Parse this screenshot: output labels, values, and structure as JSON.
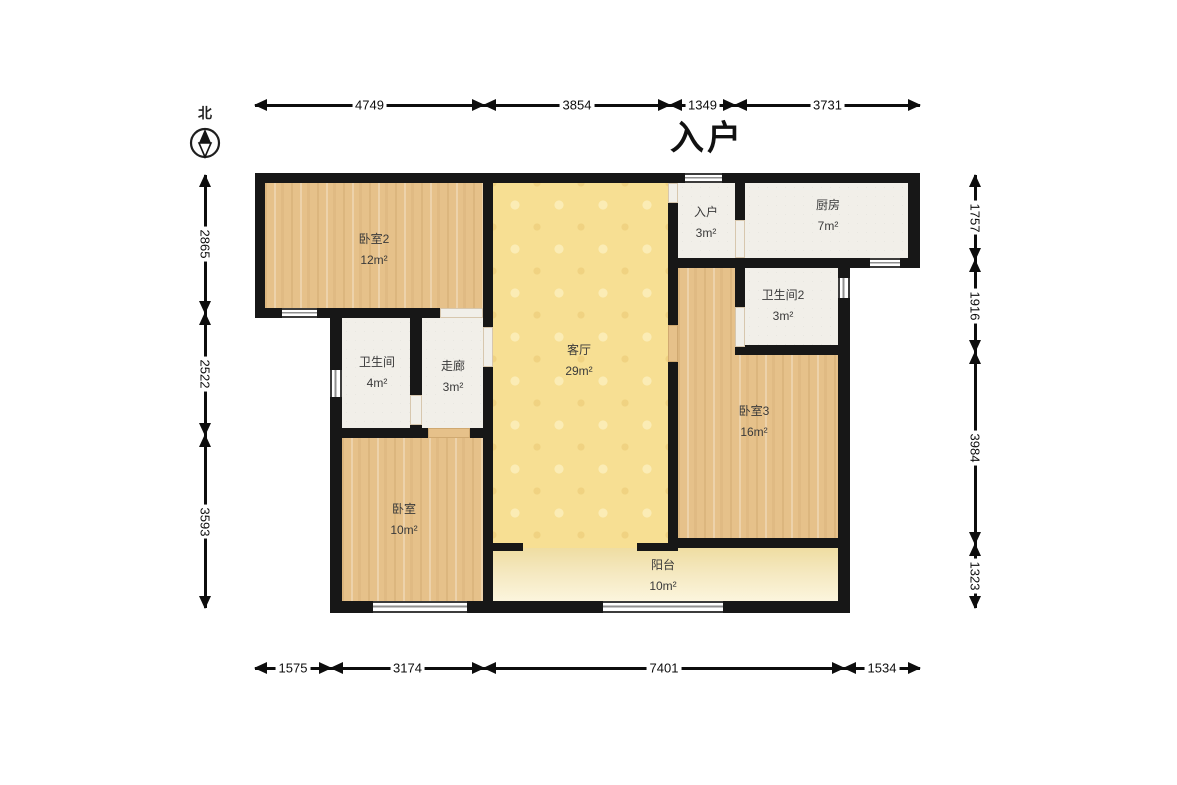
{
  "title": "入户",
  "compass": {
    "label": "北"
  },
  "rooms": [
    {
      "id": "bedroom2",
      "name": "卧室2",
      "area": "12m²",
      "floor": "wood",
      "rect": [
        265,
        183,
        218,
        125
      ],
      "label": [
        374,
        250
      ]
    },
    {
      "id": "living",
      "name": "客厅",
      "area": "29m²",
      "floor": "living",
      "rect": [
        493,
        183,
        175,
        365
      ],
      "label": [
        579,
        361
      ]
    },
    {
      "id": "entry",
      "name": "入户",
      "area": "3m²",
      "floor": "white",
      "rect": [
        678,
        183,
        57,
        75
      ],
      "label": [
        706,
        223
      ]
    },
    {
      "id": "kitchen",
      "name": "厨房",
      "area": "7m²",
      "floor": "white",
      "rect": [
        745,
        183,
        163,
        75
      ],
      "label": [
        828,
        216
      ]
    },
    {
      "id": "bedroom3",
      "name": "卧室3",
      "area": "16m²",
      "floor": "wood",
      "rect": [
        678,
        268,
        160,
        270
      ],
      "label": [
        754,
        422
      ]
    },
    {
      "id": "bath2",
      "name": "卫生间2",
      "area": "3m²",
      "floor": "white",
      "rect": [
        745,
        268,
        93,
        77
      ],
      "label": [
        783,
        306
      ]
    },
    {
      "id": "bath",
      "name": "卫生间",
      "area": "4m²",
      "floor": "white",
      "rect": [
        342,
        318,
        68,
        110
      ],
      "label": [
        377,
        373
      ]
    },
    {
      "id": "corridor",
      "name": "走廊",
      "area": "3m²",
      "floor": "white",
      "rect": [
        422,
        318,
        61,
        110
      ],
      "label": [
        453,
        377
      ]
    },
    {
      "id": "bedroom",
      "name": "卧室",
      "area": "10m²",
      "floor": "wood",
      "rect": [
        342,
        438,
        141,
        163
      ],
      "label": [
        404,
        520
      ]
    },
    {
      "id": "balcony",
      "name": "阳台",
      "area": "10m²",
      "floor": "balcony",
      "rect": [
        493,
        548,
        345,
        53
      ],
      "label": [
        663,
        576
      ]
    }
  ],
  "dimensions": {
    "top": {
      "orient": "h",
      "pos": 105,
      "segments": [
        {
          "label": "4749",
          "from": 255,
          "to": 484
        },
        {
          "label": "3854",
          "from": 484,
          "to": 670
        },
        {
          "label": "1349",
          "from": 670,
          "to": 735
        },
        {
          "label": "3731",
          "from": 735,
          "to": 920
        }
      ]
    },
    "bottom": {
      "orient": "h",
      "pos": 668,
      "segments": [
        {
          "label": "1575",
          "from": 255,
          "to": 331
        },
        {
          "label": "3174",
          "from": 331,
          "to": 484
        },
        {
          "label": "7401",
          "from": 484,
          "to": 844
        },
        {
          "label": "1534",
          "from": 844,
          "to": 920
        }
      ]
    },
    "left": {
      "orient": "v",
      "pos": 205,
      "segments": [
        {
          "label": "2865",
          "from": 175,
          "to": 313
        },
        {
          "label": "2522",
          "from": 313,
          "to": 435
        },
        {
          "label": "3593",
          "from": 435,
          "to": 608
        }
      ]
    },
    "right": {
      "orient": "v",
      "pos": 975,
      "segments": [
        {
          "label": "1757",
          "from": 175,
          "to": 260
        },
        {
          "label": "1916",
          "from": 260,
          "to": 352
        },
        {
          "label": "3984",
          "from": 352,
          "to": 544
        },
        {
          "label": "1323",
          "from": 544,
          "to": 608
        }
      ]
    }
  },
  "colors": {
    "wall": "#171717",
    "wood_floor": "#e6c18a",
    "living_floor": "#f7df93",
    "white_floor": "#f1efe9",
    "balcony_floor": "#f3e6b8",
    "dimension": "#0d0d0d"
  }
}
